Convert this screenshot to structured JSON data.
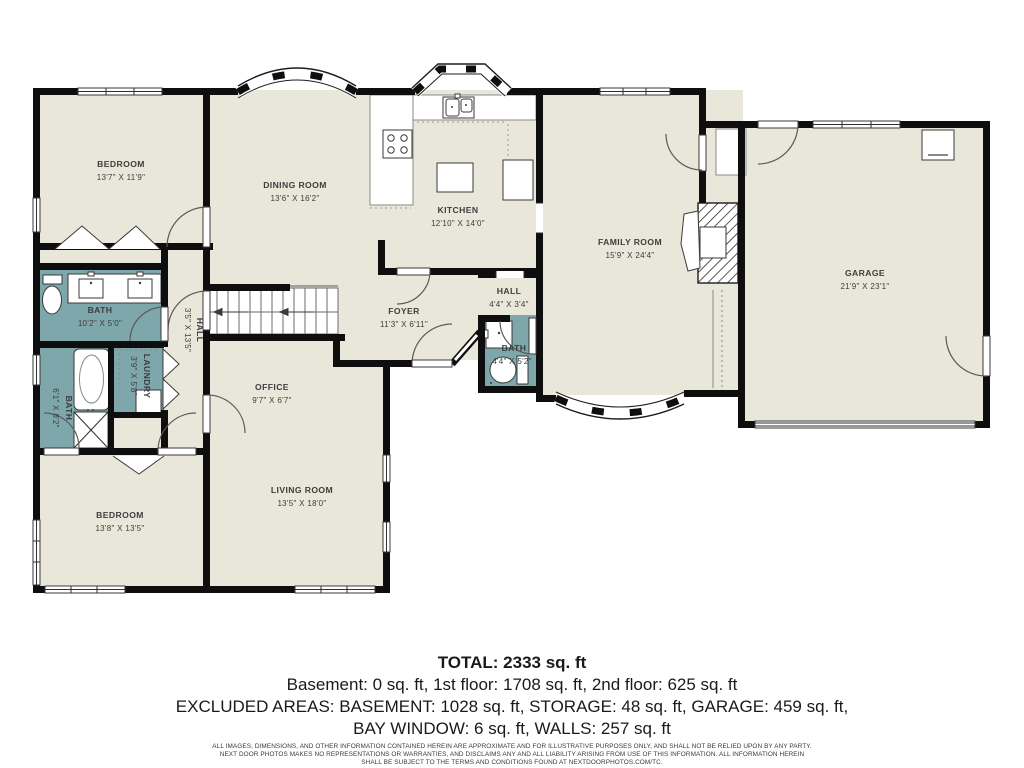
{
  "plan": {
    "rooms": [
      {
        "id": "bedroom-tl",
        "label": "BEDROOM",
        "dims": "13'7\" X 11'9\""
      },
      {
        "id": "dining",
        "label": "DINING ROOM",
        "dims": "13'6\" X 16'2\""
      },
      {
        "id": "kitchen",
        "label": "KITCHEN",
        "dims": "12'10\" X 14'0\""
      },
      {
        "id": "family",
        "label": "FAMILY ROOM",
        "dims": "15'9\" X 24'4\""
      },
      {
        "id": "garage",
        "label": "GARAGE",
        "dims": "21'9\" X 23'1\""
      },
      {
        "id": "bath-main",
        "label": "BATH",
        "dims": "10'2\" X 5'0\""
      },
      {
        "id": "hall-left",
        "label": "HALL",
        "dims": "3'5\" X 13'5\""
      },
      {
        "id": "laundry",
        "label": "LAUNDRY",
        "dims": "3'9\" X 5'8\""
      },
      {
        "id": "bath-left",
        "label": "BATH",
        "dims": "6'1\" X 8'2\""
      },
      {
        "id": "foyer",
        "label": "FOYER",
        "dims": "11'3\" X 6'11\""
      },
      {
        "id": "hall-small",
        "label": "HALL",
        "dims": "4'4\" X 3'4\""
      },
      {
        "id": "bath-small",
        "label": "BATH",
        "dims": "4'4\" X 5'2\""
      },
      {
        "id": "office",
        "label": "OFFICE",
        "dims": "9'7\" X 6'7\""
      },
      {
        "id": "living",
        "label": "LIVING ROOM",
        "dims": "13'5\" X 18'0\""
      },
      {
        "id": "bedroom-bl",
        "label": "BEDROOM",
        "dims": "13'8\" X 13'5\""
      }
    ]
  },
  "summary": {
    "total": "TOTAL: 2333 sq. ft",
    "line2": "Basement: 0 sq. ft, 1st floor: 1708 sq. ft, 2nd floor: 625 sq. ft",
    "line3": "EXCLUDED AREAS: BASEMENT: 1028 sq. ft, STORAGE: 48 sq. ft, GARAGE: 459 sq. ft,",
    "line4": "BAY WINDOW: 6 sq. ft, WALLS: 257 sq. ft",
    "disclaimer1": "ALL IMAGES, DIMENSIONS, AND OTHER INFORMATION CONTAINED HEREIN ARE APPROXIMATE AND FOR ILLUSTRATIVE PURPOSES ONLY, AND SHALL NOT BE RELIED UPON BY ANY PARTY.",
    "disclaimer2": "NEXT DOOR PHOTOS MAKES NO REPRESENTATIONS OR WARRANTIES, AND DISCLAIMS ANY AND ALL LIABILITY ARISING FROM USE OF THIS INFORMATION. ALL INFORMATION HEREIN",
    "disclaimer3": "SHALL BE SUBJECT TO THE TERMS AND CONDITIONS FOUND AT NEXTDOORPHOTOS.COM/TC."
  },
  "colors": {
    "floor": "#e9e6da",
    "bath": "#7da7ab",
    "wall": "#0e0e0e",
    "label": "#3d3d3d",
    "background": "#ffffff"
  }
}
